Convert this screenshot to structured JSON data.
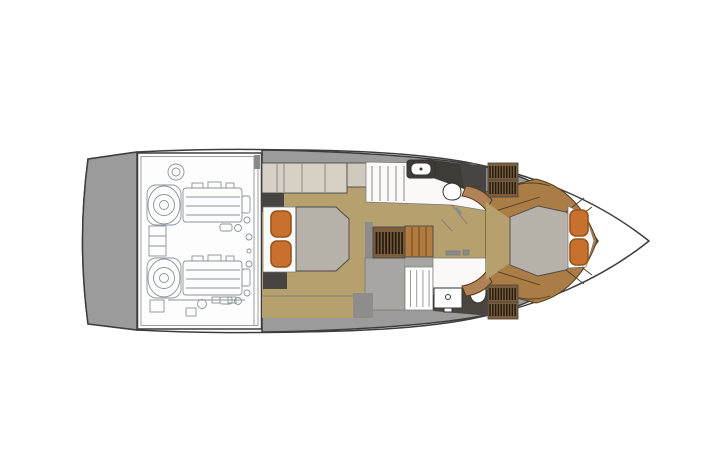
{
  "image": {
    "alt": "Top-down floor plan diagram of a motor yacht lower deck, no text labels visible"
  },
  "colors": {
    "background": "#ffffff",
    "outline_dark": "#3d3d3d",
    "bow_white": "#ffffff",
    "platform_gray": "#9b9b9b",
    "deck_gray": "#9b9b9b",
    "engine_room_white": "#fdfdfd",
    "engine_line_gray": "#8b939b",
    "wall_inner_gray": "#8f8d8b",
    "landing_gray": "#a8a6a2",
    "floor_tan": "#b5a06e",
    "cabinet_beige": "#d7d0c5",
    "cabinet_beige_alt": "#cfc9bf",
    "dark_fixture": "#484441",
    "bed_white": "#fbfbfa",
    "mattress_gray": "#b6b1a9",
    "pillow_orange": "#c8702e",
    "pillow_border": "#99531b",
    "wood_brown": "#a97d45",
    "step_brown": "#b28257",
    "hatch_wood": "#7d5d39",
    "hatch_stripe": "#201a12",
    "side_step_brown": "#b27c41",
    "stair_white": "#ffffff",
    "bath_white": "#faf9f7",
    "counter_dark": "#3f3b37",
    "floor_dark": "#4b4540",
    "hardware_gray": "#8a8a8a"
  },
  "icons": {
    "engine": "engine-line-art",
    "toilet": "toilet-icon",
    "sink": "sink-icon",
    "stairs": "stair-treads-icon",
    "hatch": "louvered-hatch-icon",
    "wardrobe": "hatched-wardrobe-icon",
    "pillow": "pillow-icon",
    "door": "door-swing-icon"
  }
}
